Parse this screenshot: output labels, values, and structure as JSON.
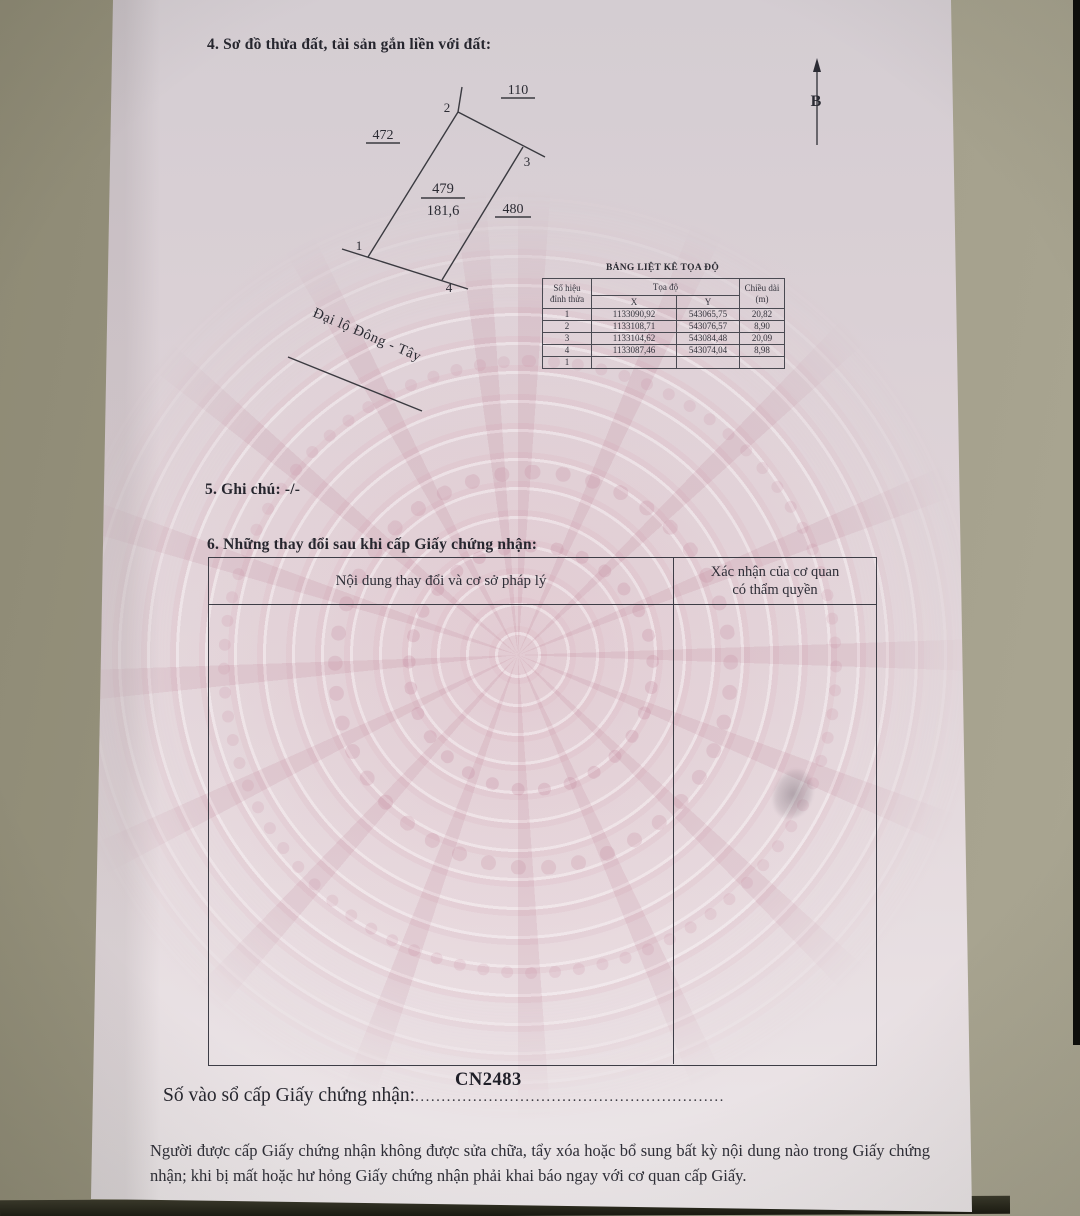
{
  "page": {
    "section4_title": "4. Sơ đồ thửa đất, tài sản gắn liền với đất:",
    "section5_label": "5. Ghi chú:",
    "section5_value": "-/-",
    "section6_title": "6. Những thay đổi sau khi cấp Giấy chứng nhận:",
    "registry_label": "Số vào sổ cấp Giấy chứng nhận:",
    "registry_number": "CN2483",
    "registry_dots": "...........................................................",
    "footer_text": "Người được cấp Giấy chứng nhận không được sửa chữa, tẩy xóa hoặc bổ sung bất kỳ nội dung nào trong Giấy chứng nhận; khi bị mất hoặc hư hỏng Giấy chứng nhận phải khai báo ngay với cơ quan cấp Giấy."
  },
  "diagram": {
    "north_label": "B",
    "parcel_number": "479",
    "parcel_area": "181,6",
    "adjacent_top": "110",
    "adjacent_left": "472",
    "adjacent_right": "480",
    "vertex1": "1",
    "vertex2": "2",
    "vertex3": "3",
    "vertex4": "4",
    "road_name": "Đại lộ Đông - Tây"
  },
  "coord_table": {
    "title": "BẢNG LIỆT KÊ TỌA ĐỘ",
    "col_vertex_line1": "Số hiệu",
    "col_vertex_line2": "đỉnh thửa",
    "col_coords": "Tọa độ",
    "col_x": "X",
    "col_y": "Y",
    "col_length_line1": "Chiều dài",
    "col_length_line2": "(m)",
    "rows": [
      {
        "id": "1",
        "x": "1133090,92",
        "y": "543065,75",
        "len": "20,82"
      },
      {
        "id": "2",
        "x": "1133108,71",
        "y": "543076,57",
        "len": "8,90"
      },
      {
        "id": "3",
        "x": "1133104,62",
        "y": "543084,48",
        "len": "20,09"
      },
      {
        "id": "4",
        "x": "1133087,46",
        "y": "543074,04",
        "len": "8,98"
      },
      {
        "id": "1",
        "x": "",
        "y": "",
        "len": ""
      }
    ]
  },
  "changes_table": {
    "col_content": "Nội dung thay đổi và cơ sở pháp lý",
    "col_confirm_line1": "Xác nhận của cơ quan",
    "col_confirm_line2": "có thẩm quyền"
  }
}
